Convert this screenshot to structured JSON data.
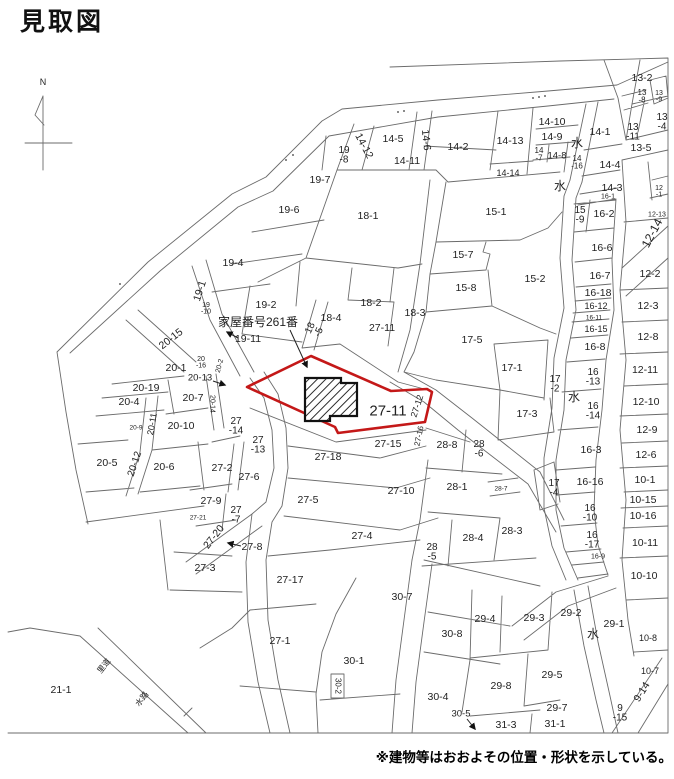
{
  "page": {
    "title": "見取図",
    "note": "※建物等はおおよその位置・形状を示している。"
  },
  "compass": {
    "label": "N"
  },
  "annotation": {
    "text": "家屋番号261番"
  },
  "highlight": {
    "parcel_label": "27-11",
    "color": "#c41818"
  },
  "map": {
    "labels": [
      {
        "t": "N",
        "x": 43,
        "y": 82,
        "s": 9,
        "n": "compass-label"
      },
      {
        "t": "家屋番号261番",
        "x": 218,
        "y": 322,
        "s": 12,
        "a": "start",
        "n": "annotation-label"
      },
      {
        "t": "19-7",
        "x": 320,
        "y": 180
      },
      {
        "l": [
          "19",
          "-8"
        ],
        "x": 344,
        "y": 150,
        "s": 10
      },
      {
        "t": "14-12",
        "x": 364,
        "y": 146,
        "r": 62
      },
      {
        "t": "14-5",
        "x": 393,
        "y": 139
      },
      {
        "t": "14-6",
        "x": 426,
        "y": 140,
        "r": 84
      },
      {
        "t": "14-2",
        "x": 458,
        "y": 147
      },
      {
        "t": "14-11",
        "x": 407,
        "y": 161
      },
      {
        "t": "14-13",
        "x": 510,
        "y": 141
      },
      {
        "t": "14-10",
        "x": 552,
        "y": 122
      },
      {
        "t": "14-9",
        "x": 552,
        "y": 137
      },
      {
        "l": [
          "14",
          "-7"
        ],
        "x": 539,
        "y": 150,
        "s": 8
      },
      {
        "t": "14-8",
        "x": 557,
        "y": 156,
        "s": 9.5
      },
      {
        "l": [
          "14",
          "-16"
        ],
        "x": 577,
        "y": 158,
        "s": 8
      },
      {
        "t": "14-14",
        "x": 508,
        "y": 173,
        "s": 9
      },
      {
        "t": "水",
        "x": 577,
        "y": 143,
        "s": 12
      },
      {
        "t": "水",
        "x": 560,
        "y": 186,
        "s": 12
      },
      {
        "t": "14-1",
        "x": 600,
        "y": 132
      },
      {
        "t": "14-4",
        "x": 610,
        "y": 165
      },
      {
        "t": "14-3",
        "x": 612,
        "y": 188
      },
      {
        "t": "16-1",
        "x": 608,
        "y": 197,
        "s": 7
      },
      {
        "t": "18-1",
        "x": 368,
        "y": 216
      },
      {
        "t": "19-6",
        "x": 289,
        "y": 210
      },
      {
        "t": "19-4",
        "x": 233,
        "y": 263
      },
      {
        "t": "19-1",
        "x": 200,
        "y": 291,
        "r": -72
      },
      {
        "l": [
          "19",
          "-10"
        ],
        "x": 206,
        "y": 305,
        "s": 7
      },
      {
        "t": "19-2",
        "x": 266,
        "y": 305
      },
      {
        "t": "19-11",
        "x": 248,
        "y": 339
      },
      {
        "t": "13-2",
        "x": 642,
        "y": 78
      },
      {
        "l": [
          "13",
          "-8"
        ],
        "x": 642,
        "y": 92,
        "s": 8
      },
      {
        "l": [
          "13",
          "-9"
        ],
        "x": 659,
        "y": 93,
        "s": 7
      },
      {
        "l": [
          "13",
          "-4"
        ],
        "x": 662,
        "y": 117,
        "s": 10
      },
      {
        "l": [
          "13",
          "-11"
        ],
        "x": 633,
        "y": 127,
        "s": 10
      },
      {
        "t": "13-5",
        "x": 641,
        "y": 148
      },
      {
        "l": [
          "12",
          "-1"
        ],
        "x": 659,
        "y": 188,
        "s": 7
      },
      {
        "t": "12-13",
        "x": 657,
        "y": 215,
        "s": 7
      },
      {
        "t": "12-14",
        "x": 652,
        "y": 233,
        "r": -62,
        "s": 12
      },
      {
        "t": "12-2",
        "x": 650,
        "y": 274
      },
      {
        "t": "12-3",
        "x": 648,
        "y": 306
      },
      {
        "t": "12-8",
        "x": 648,
        "y": 337
      },
      {
        "t": "12-11",
        "x": 645,
        "y": 370
      },
      {
        "t": "12-10",
        "x": 646,
        "y": 402
      },
      {
        "t": "12-9",
        "x": 647,
        "y": 430
      },
      {
        "t": "12-6",
        "x": 646,
        "y": 455
      },
      {
        "t": "10-1",
        "x": 645,
        "y": 480
      },
      {
        "t": "10-15",
        "x": 643,
        "y": 500
      },
      {
        "t": "10-16",
        "x": 643,
        "y": 516
      },
      {
        "t": "10-11",
        "x": 645,
        "y": 543
      },
      {
        "t": "10-10",
        "x": 644,
        "y": 576
      },
      {
        "t": "10-8",
        "x": 648,
        "y": 638,
        "s": 9
      },
      {
        "t": "10-7",
        "x": 650,
        "y": 671,
        "s": 9
      },
      {
        "t": "9-14",
        "x": 642,
        "y": 692,
        "r": -58
      },
      {
        "l": [
          "9",
          "-15"
        ],
        "x": 620,
        "y": 708,
        "s": 10
      },
      {
        "t": "15-1",
        "x": 496,
        "y": 212
      },
      {
        "l": [
          "15",
          "-9"
        ],
        "x": 580,
        "y": 210,
        "s": 10
      },
      {
        "t": "16-2",
        "x": 604,
        "y": 214
      },
      {
        "t": "15-7",
        "x": 463,
        "y": 255
      },
      {
        "t": "15-8",
        "x": 466,
        "y": 288
      },
      {
        "t": "15-2",
        "x": 535,
        "y": 279
      },
      {
        "t": "16-6",
        "x": 602,
        "y": 248
      },
      {
        "t": "16-7",
        "x": 600,
        "y": 276
      },
      {
        "t": "16-18",
        "x": 598,
        "y": 293
      },
      {
        "t": "16-12",
        "x": 596,
        "y": 306,
        "s": 9
      },
      {
        "t": "16-11",
        "x": 594,
        "y": 318,
        "s": 6.5
      },
      {
        "t": "16-15",
        "x": 596,
        "y": 329,
        "s": 9
      },
      {
        "t": "16-8",
        "x": 595,
        "y": 347
      },
      {
        "l": [
          "16",
          "-13"
        ],
        "x": 593,
        "y": 372,
        "s": 10
      },
      {
        "t": "水",
        "x": 574,
        "y": 397,
        "s": 12
      },
      {
        "l": [
          "16",
          "-14"
        ],
        "x": 593,
        "y": 406,
        "s": 10
      },
      {
        "t": "16-3",
        "x": 591,
        "y": 450
      },
      {
        "t": "16-16",
        "x": 590,
        "y": 482
      },
      {
        "l": [
          "16",
          "-10"
        ],
        "x": 590,
        "y": 508,
        "s": 10
      },
      {
        "l": [
          "16",
          "-17"
        ],
        "x": 592,
        "y": 535,
        "s": 10
      },
      {
        "t": "16-9",
        "x": 598,
        "y": 557,
        "s": 7
      },
      {
        "t": "17-5",
        "x": 472,
        "y": 340
      },
      {
        "t": "17-1",
        "x": 512,
        "y": 368
      },
      {
        "l": [
          "17",
          "-2"
        ],
        "x": 555,
        "y": 379,
        "s": 10
      },
      {
        "t": "17-3",
        "x": 527,
        "y": 414
      },
      {
        "l": [
          "17",
          "-4"
        ],
        "x": 554,
        "y": 483,
        "s": 10
      },
      {
        "t": "18-2",
        "x": 371,
        "y": 303
      },
      {
        "t": "18-3",
        "x": 415,
        "y": 313
      },
      {
        "t": "18-4",
        "x": 331,
        "y": 318
      },
      {
        "l": [
          "18",
          "-5"
        ],
        "x": 310,
        "y": 328,
        "r": -65,
        "s": 10
      },
      {
        "t": "27-11",
        "x": 382,
        "y": 328
      },
      {
        "t": "27-11",
        "x": 388,
        "y": 411,
        "s": 15,
        "n": "highlighted-parcel-label"
      },
      {
        "t": "27-12",
        "x": 417,
        "y": 406,
        "r": -72,
        "s": 9
      },
      {
        "t": "27-16",
        "x": 419,
        "y": 436,
        "r": -78,
        "s": 8
      },
      {
        "t": "27-15",
        "x": 388,
        "y": 444
      },
      {
        "t": "27-18",
        "x": 328,
        "y": 457
      },
      {
        "l": [
          "27",
          "-14"
        ],
        "x": 236,
        "y": 421,
        "s": 10
      },
      {
        "l": [
          "27",
          "-13"
        ],
        "x": 258,
        "y": 440,
        "s": 10
      },
      {
        "t": "27-2",
        "x": 222,
        "y": 468
      },
      {
        "t": "27-6",
        "x": 249,
        "y": 477
      },
      {
        "t": "27-9",
        "x": 211,
        "y": 501
      },
      {
        "l": [
          "27",
          "-7"
        ],
        "x": 236,
        "y": 510,
        "s": 10
      },
      {
        "t": "27-21",
        "x": 198,
        "y": 518,
        "s": 6.5
      },
      {
        "t": "27-20",
        "x": 214,
        "y": 537,
        "r": -52
      },
      {
        "t": "27-8",
        "x": 252,
        "y": 547
      },
      {
        "t": "27-3",
        "x": 205,
        "y": 568
      },
      {
        "t": "27-5",
        "x": 308,
        "y": 500
      },
      {
        "t": "27-10",
        "x": 401,
        "y": 491
      },
      {
        "t": "27-4",
        "x": 362,
        "y": 536
      },
      {
        "t": "27-17",
        "x": 290,
        "y": 580
      },
      {
        "t": "27-1",
        "x": 280,
        "y": 641
      },
      {
        "t": "28-8",
        "x": 447,
        "y": 445
      },
      {
        "l": [
          "28",
          "-6"
        ],
        "x": 479,
        "y": 444,
        "s": 10
      },
      {
        "t": "28-1",
        "x": 457,
        "y": 487
      },
      {
        "t": "28-7",
        "x": 501,
        "y": 489,
        "s": 6.5
      },
      {
        "t": "28-4",
        "x": 473,
        "y": 538
      },
      {
        "t": "28-3",
        "x": 512,
        "y": 531
      },
      {
        "l": [
          "28",
          "-5"
        ],
        "x": 432,
        "y": 547,
        "s": 10
      },
      {
        "t": "20-15",
        "x": 171,
        "y": 339,
        "r": -38
      },
      {
        "l": [
          "20",
          "-16"
        ],
        "x": 201,
        "y": 359,
        "s": 7
      },
      {
        "t": "20-1",
        "x": 176,
        "y": 368
      },
      {
        "t": "20-2",
        "x": 220,
        "y": 366,
        "r": -75,
        "s": 7
      },
      {
        "t": "20-13",
        "x": 200,
        "y": 378,
        "s": 9.5
      },
      {
        "t": "20-19",
        "x": 146,
        "y": 388
      },
      {
        "t": "20-4",
        "x": 129,
        "y": 402
      },
      {
        "t": "20-7",
        "x": 193,
        "y": 398
      },
      {
        "t": "20-14",
        "x": 212,
        "y": 404,
        "r": 90,
        "s": 7
      },
      {
        "t": "20-10",
        "x": 181,
        "y": 426
      },
      {
        "t": "20-9",
        "x": 136,
        "y": 428,
        "s": 6.5
      },
      {
        "t": "20-11",
        "x": 152,
        "y": 424,
        "r": -80,
        "s": 9
      },
      {
        "t": "20-12",
        "x": 135,
        "y": 464,
        "r": -72,
        "s": 10
      },
      {
        "t": "20-5",
        "x": 107,
        "y": 463
      },
      {
        "t": "20-6",
        "x": 164,
        "y": 467
      },
      {
        "t": "30-7",
        "x": 402,
        "y": 597
      },
      {
        "t": "30-8",
        "x": 452,
        "y": 634
      },
      {
        "t": "30-1",
        "x": 354,
        "y": 661
      },
      {
        "t": "30-2",
        "x": 338,
        "y": 686,
        "r": 90,
        "s": 8
      },
      {
        "t": "30-4",
        "x": 438,
        "y": 697
      },
      {
        "t": "30-5",
        "x": 461,
        "y": 714,
        "s": 9.5
      },
      {
        "t": "29-2",
        "x": 571,
        "y": 613
      },
      {
        "t": "29-1",
        "x": 614,
        "y": 624
      },
      {
        "t": "水",
        "x": 593,
        "y": 634,
        "s": 12
      },
      {
        "t": "29-4",
        "x": 485,
        "y": 619
      },
      {
        "t": "29-3",
        "x": 534,
        "y": 618
      },
      {
        "t": "29-5",
        "x": 552,
        "y": 675
      },
      {
        "t": "29-8",
        "x": 501,
        "y": 686
      },
      {
        "t": "29-7",
        "x": 557,
        "y": 708
      },
      {
        "t": "31-3",
        "x": 506,
        "y": 725
      },
      {
        "t": "31-1",
        "x": 555,
        "y": 724
      },
      {
        "t": "21-1",
        "x": 61,
        "y": 690
      },
      {
        "t": "里道",
        "x": 104,
        "y": 666,
        "r": -52,
        "s": 8
      },
      {
        "t": "水路",
        "x": 142,
        "y": 699,
        "r": -52,
        "s": 8
      }
    ]
  }
}
